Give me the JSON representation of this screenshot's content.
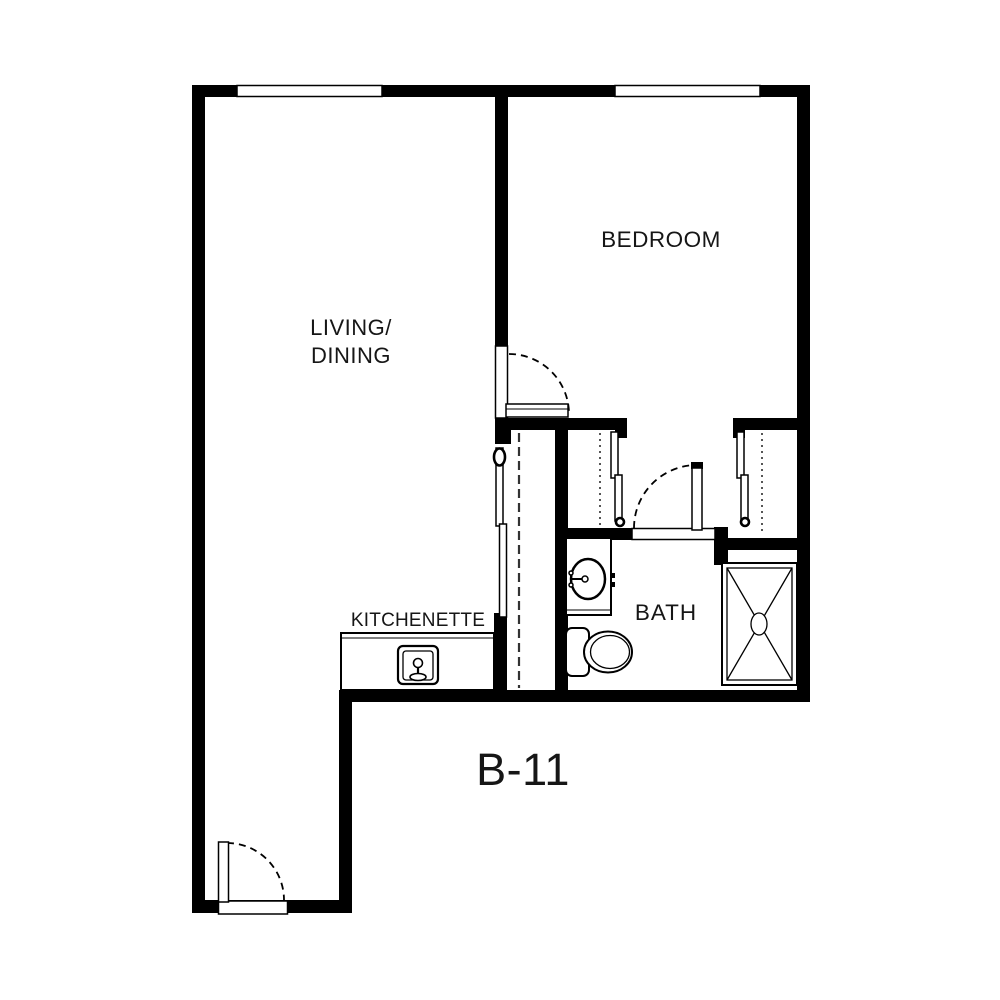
{
  "plan": {
    "unit_label": "B-11",
    "labels": {
      "living_line1": "LIVING/",
      "living_line2": "DINING",
      "bedroom": "BEDROOM",
      "kitchenette": "KITCHENETTE",
      "bath": "BATH"
    },
    "fixtures": {
      "kitchen_sink": "kitchen-sink-icon",
      "bathroom_sink": "bathroom-sink-icon",
      "toilet": "toilet-icon",
      "shower": "shower-icon",
      "closets": "sliding-door-closets",
      "doors": "swing-doors-dashed-arcs",
      "windows": "wall-windows"
    },
    "colors": {
      "wall": "#000000",
      "background": "#ffffff",
      "line": "#000000"
    }
  }
}
